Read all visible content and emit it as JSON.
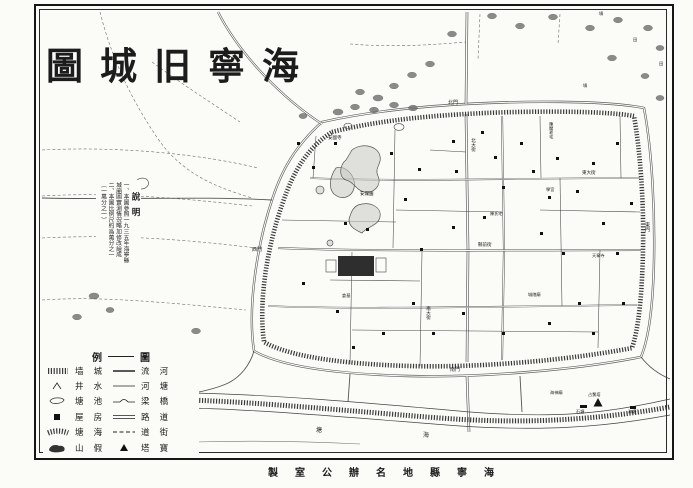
{
  "title": {
    "text": "海寧旧城圖",
    "display": "圖城旧寧海"
  },
  "notes": {
    "heading": "說明",
    "lines": [
      "一、本圖參照一九三五年海寧縣",
      "城廂圖實測情況略加修改繪成",
      "二、本圖比例尺約爲萬分之一",
      "（一萬分之一）"
    ]
  },
  "legend": {
    "title": "圖例",
    "title_left": "例",
    "title_right": "圖",
    "left": [
      {
        "symbol": "city-wall",
        "label": "城墙",
        "display": "墙 城"
      },
      {
        "symbol": "well",
        "label": "水井",
        "display": "井 水"
      },
      {
        "symbol": "pond",
        "label": "池塘",
        "display": "塘 池"
      },
      {
        "symbol": "house",
        "label": "房屋",
        "display": "屋 房"
      },
      {
        "symbol": "seawall",
        "label": "海塘",
        "display": "塘 海"
      },
      {
        "symbol": "rockery",
        "label": "假山",
        "display": "山 假"
      }
    ],
    "right": [
      {
        "symbol": "river",
        "label": "河流",
        "display": "流 河"
      },
      {
        "symbol": "canal",
        "label": "塘河",
        "display": "河 塘"
      },
      {
        "symbol": "bridge",
        "label": "橋梁",
        "display": "梁 橋"
      },
      {
        "symbol": "road",
        "label": "道路",
        "display": "路 道"
      },
      {
        "symbol": "street",
        "label": "街道",
        "display": "道 街"
      },
      {
        "symbol": "pagoda",
        "label": "寶塔",
        "display": "塔 寶"
      }
    ]
  },
  "attribution": {
    "text": "海寧縣地名辦公室製",
    "display": "製室公辦名地縣寧海"
  },
  "map_labels": [
    {
      "t": "北門",
      "x": 448,
      "y": 101,
      "s": 5
    },
    {
      "t": "東門",
      "x": 644,
      "y": 222,
      "s": 5,
      "v": true
    },
    {
      "t": "南門",
      "x": 450,
      "y": 368,
      "s": 5
    },
    {
      "t": "西門",
      "x": 252,
      "y": 248,
      "s": 5
    },
    {
      "t": "北大街",
      "x": 471,
      "y": 138,
      "s": 4.5,
      "v": true
    },
    {
      "t": "南大街",
      "x": 426,
      "y": 306,
      "s": 4.5,
      "v": true
    },
    {
      "t": "縣前街",
      "x": 478,
      "y": 243,
      "s": 4.5
    },
    {
      "t": "東大街",
      "x": 582,
      "y": 171,
      "s": 4.5
    },
    {
      "t": "安瀾園",
      "x": 360,
      "y": 192,
      "s": 4.5
    },
    {
      "t": "安國寺",
      "x": 328,
      "y": 136,
      "s": 4.5
    },
    {
      "t": "陳閣老宅",
      "x": 549,
      "y": 122,
      "s": 4.2,
      "v": true
    },
    {
      "t": "陳氏宅",
      "x": 490,
      "y": 212,
      "s": 4.2
    },
    {
      "t": "城隍廟",
      "x": 528,
      "y": 293,
      "s": 4.2
    },
    {
      "t": "學宮",
      "x": 546,
      "y": 188,
      "s": 4.2
    },
    {
      "t": "天寧寺",
      "x": 592,
      "y": 254,
      "s": 4.2
    },
    {
      "t": "倉基",
      "x": 342,
      "y": 294,
      "s": 4.2
    },
    {
      "t": "占鰲塔",
      "x": 588,
      "y": 393,
      "s": 4.2
    },
    {
      "t": "海神廟",
      "x": 550,
      "y": 391,
      "s": 4.2
    },
    {
      "t": "石塘",
      "x": 576,
      "y": 410,
      "s": 4.2
    },
    {
      "t": "海塘",
      "x": 628,
      "y": 410,
      "s": 4.2
    },
    {
      "t": "塘",
      "x": 316,
      "y": 428,
      "s": 6
    },
    {
      "t": "海",
      "x": 423,
      "y": 433,
      "s": 6
    },
    {
      "t": "墳",
      "x": 599,
      "y": 12,
      "s": 4.2
    },
    {
      "t": "田",
      "x": 633,
      "y": 38,
      "s": 4.2
    },
    {
      "t": "墳",
      "x": 583,
      "y": 84,
      "s": 4.2
    },
    {
      "t": "田",
      "x": 659,
      "y": 62,
      "s": 4.2
    }
  ]
}
